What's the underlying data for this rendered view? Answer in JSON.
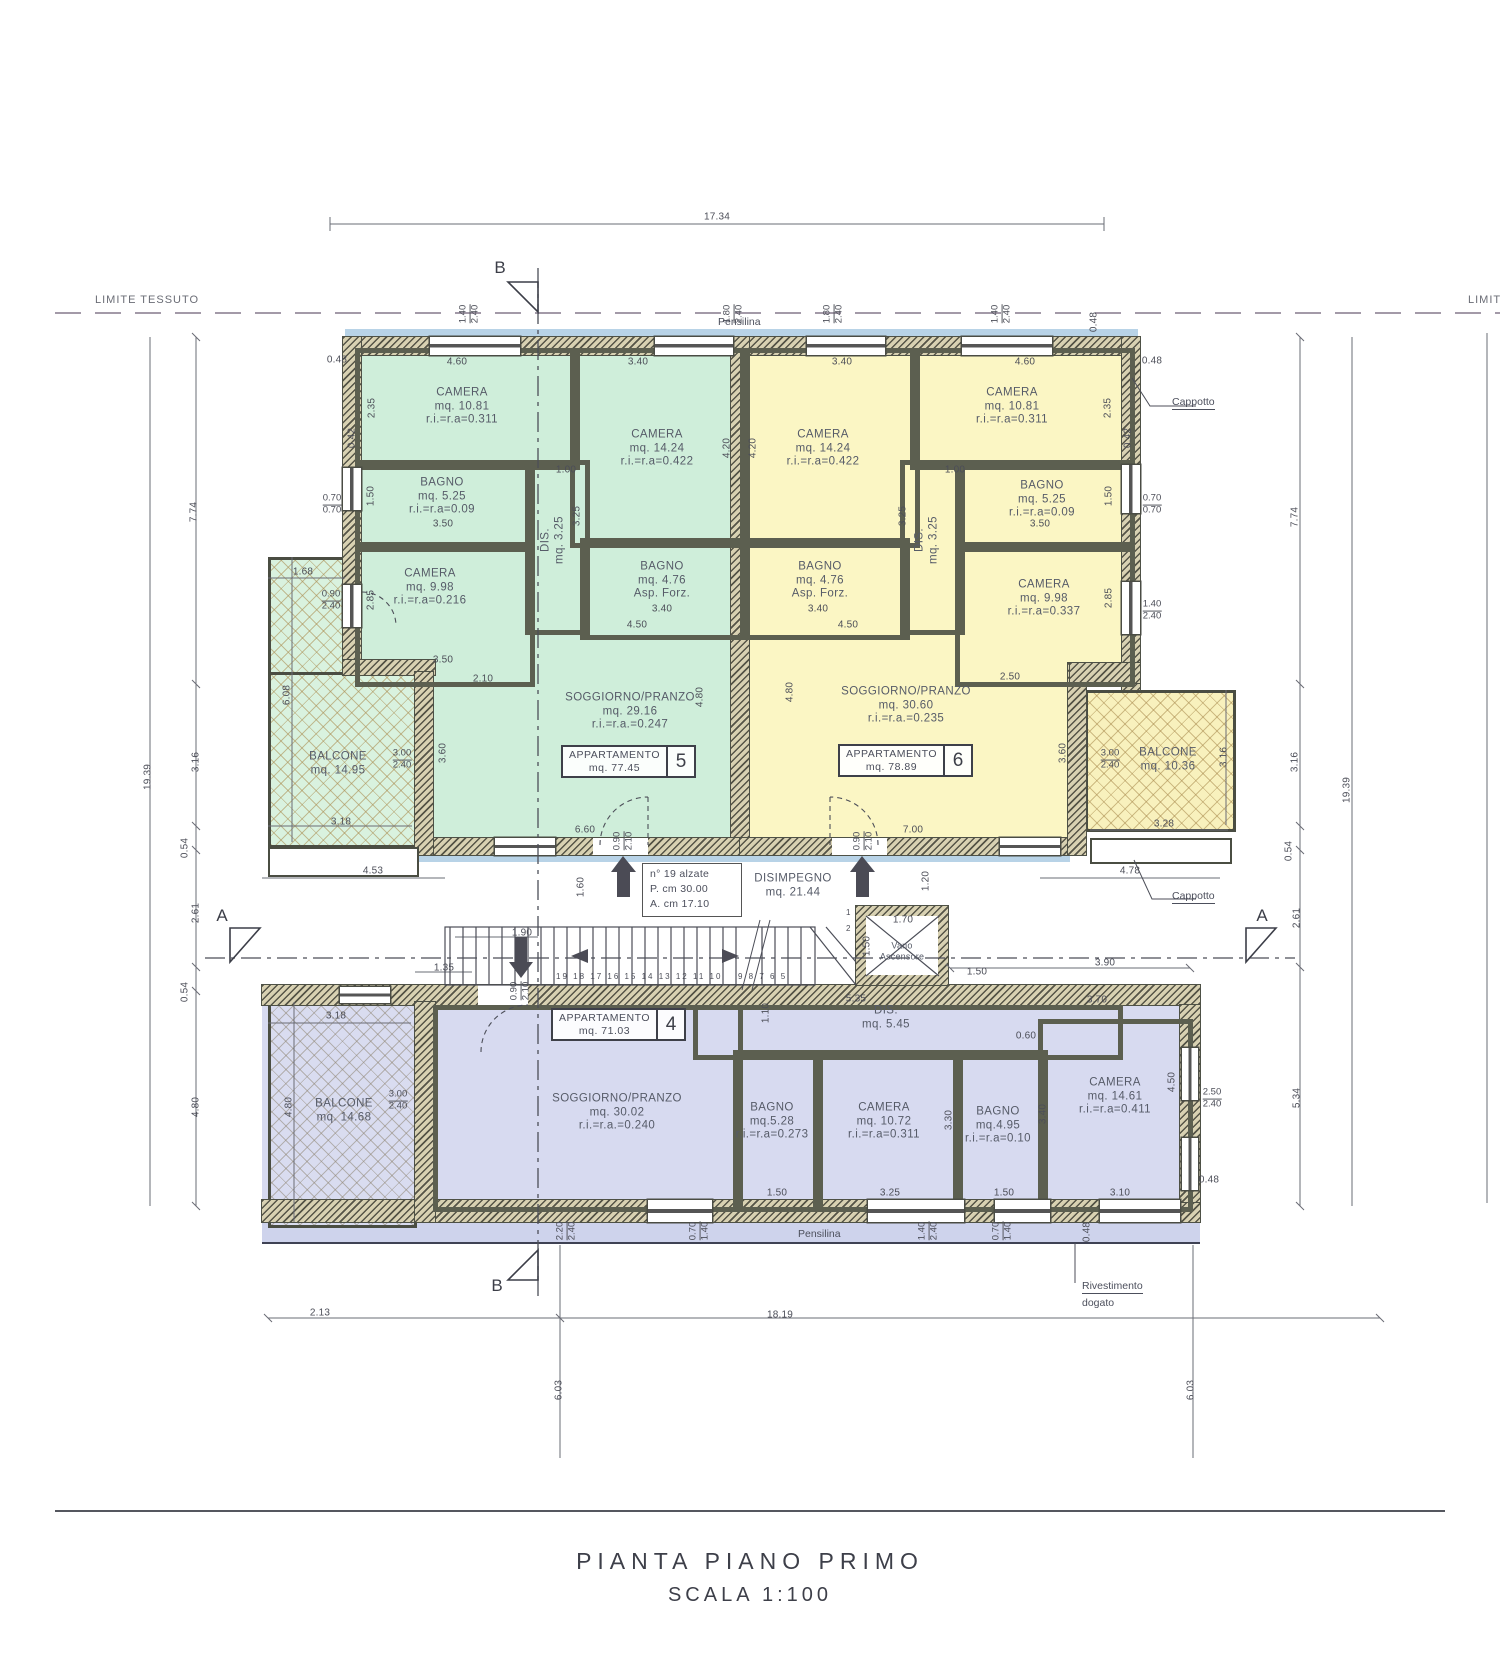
{
  "title": {
    "line1": "PIANTA  PIANO  PRIMO",
    "line2": "SCALA  1:100"
  },
  "labels": {
    "limite_left": "LIMITE TESSUTO",
    "limite_right": "LIMITE TESSUTO",
    "pensilina_top": "Pensilina",
    "pensilina_bottom": "Pensilina",
    "cappotto_top": "Cappotto",
    "cappotto_mid": "Cappotto",
    "rivestimento_line1": "Rivestimento",
    "rivestimento_line2": "dogato",
    "section_a": "A",
    "section_b": "B"
  },
  "stair_note": {
    "line1": "n° 19 alzate",
    "line2": "P.  cm 30.00",
    "line3": "A. cm 17.10"
  },
  "hall": {
    "name": "DISIMPEGNO",
    "area": "mq. 21.44"
  },
  "elevator": {
    "line1": "Vano",
    "line2": "Ascensore"
  },
  "stairs": {
    "numbers_left": "19 18 17 16 15 14 13 12 11 10",
    "numbers_right": "9  8  7  6  5",
    "digit_1": "1",
    "digit_2": "2"
  },
  "apartments": [
    {
      "name": "APPARTAMENTO",
      "area": "mq. 77.45",
      "number": "5"
    },
    {
      "name": "APPARTAMENTO",
      "area": "mq. 78.89",
      "number": "6"
    },
    {
      "name": "APPARTAMENTO",
      "area": "mq. 71.03",
      "number": "4"
    }
  ],
  "colors": {
    "apt5_fill": "#cfeeda",
    "apt6_fill": "#fbf6c4",
    "apt4_fill": "#d7daf0",
    "wall_hatch": "#d8d1b2",
    "trim_teal": "#8ecfc0",
    "trim_blue": "#b3d2e6",
    "line_dark": "#3e4049",
    "dim_text": "#4c4e58"
  },
  "rooms": [
    {
      "lines": [
        "CAMERA",
        "mq. 10.81",
        "r.i.=r.a=0.311"
      ],
      "x": 462,
      "y": 407
    },
    {
      "lines": [
        "CAMERA",
        "mq. 14.24",
        "r.i.=r.a=0.422"
      ],
      "x": 657,
      "y": 449
    },
    {
      "lines": [
        "BAGNO",
        "mq. 5.25",
        "r.i.=r.a=0.09"
      ],
      "x": 442,
      "y": 497
    },
    {
      "lines": [
        "CAMERA",
        "mq. 9.98",
        "r.i.=r.a=0.216"
      ],
      "x": 430,
      "y": 588
    },
    {
      "lines": [
        "DIS.",
        "mq. 3.25"
      ],
      "x": 553,
      "y": 540,
      "rot": 1
    },
    {
      "lines": [
        "BAGNO",
        "mq. 4.76",
        "Asp. Forz."
      ],
      "x": 662,
      "y": 581
    },
    {
      "lines": [
        "SOGGIORNO/PRANZO",
        "mq. 29.16",
        "r.i.=r.a.=0.247"
      ],
      "x": 630,
      "y": 712
    },
    {
      "lines": [
        "CAMERA",
        "mq. 14.24",
        "r.i.=r.a=0.422"
      ],
      "x": 823,
      "y": 449
    },
    {
      "lines": [
        "CAMERA",
        "mq. 10.81",
        "r.i.=r.a=0.311"
      ],
      "x": 1012,
      "y": 407
    },
    {
      "lines": [
        "BAGNO",
        "mq. 5.25",
        "r.i.=r.a=0.09"
      ],
      "x": 1042,
      "y": 500
    },
    {
      "lines": [
        "DIS.",
        "mq. 3.25"
      ],
      "x": 927,
      "y": 540,
      "rot": 1
    },
    {
      "lines": [
        "BAGNO",
        "mq. 4.76",
        "Asp. Forz."
      ],
      "x": 820,
      "y": 581
    },
    {
      "lines": [
        "CAMERA",
        "mq. 9.98",
        "r.i.=r.a=0.337"
      ],
      "x": 1044,
      "y": 599
    },
    {
      "lines": [
        "SOGGIORNO/PRANZO",
        "mq. 30.60",
        "r.i.=r.a.=0.235"
      ],
      "x": 906,
      "y": 706
    },
    {
      "lines": [
        "SOGGIORNO/PRANZO",
        "mq. 30.02",
        "r.i.=r.a.=0.240"
      ],
      "x": 617,
      "y": 1113
    },
    {
      "lines": [
        "BAGNO",
        "mq.5.28",
        "r.i.=r.a=0.273"
      ],
      "x": 772,
      "y": 1122
    },
    {
      "lines": [
        "CAMERA",
        "mq. 10.72",
        "r.i.=r.a=0.311"
      ],
      "x": 884,
      "y": 1122
    },
    {
      "lines": [
        "BAGNO",
        "mq.4.95",
        "r.i.=r.a=0.10"
      ],
      "x": 998,
      "y": 1126
    },
    {
      "lines": [
        "CAMERA",
        "mq. 14.61",
        "r.i.=r.a=0.411"
      ],
      "x": 1115,
      "y": 1097
    },
    {
      "lines": [
        "DIS.",
        "mq. 5.45"
      ],
      "x": 886,
      "y": 1018
    }
  ],
  "balconies": [
    {
      "lines": [
        "BALCONE",
        "mq. 14.95"
      ],
      "x": 338,
      "y": 764
    },
    {
      "lines": [
        "BALCONE",
        "mq. 10.36"
      ],
      "x": 1168,
      "y": 760
    },
    {
      "lines": [
        "BALCONE",
        "mq. 14.68"
      ],
      "x": 344,
      "y": 1111
    }
  ],
  "dims": [
    {
      "t": "17.34",
      "x": 717,
      "y": 217
    },
    {
      "t": "0.48",
      "x": 337,
      "y": 360
    },
    {
      "t": "4.60",
      "x": 457,
      "y": 362
    },
    {
      "t": "3.40",
      "x": 638,
      "y": 362
    },
    {
      "t": "3.40",
      "x": 842,
      "y": 362
    },
    {
      "t": "4.60",
      "x": 1025,
      "y": 362
    },
    {
      "t": "0.48",
      "x": 1152,
      "y": 361
    },
    {
      "t": "0.48",
      "x": 1094,
      "y": 322,
      "r": 1
    },
    {
      "t": "19.39",
      "x": 148,
      "y": 777,
      "r": 1
    },
    {
      "t": "7.74",
      "x": 194,
      "y": 512,
      "r": 1
    },
    {
      "t": "3.16",
      "x": 196,
      "y": 762,
      "r": 1
    },
    {
      "t": "0.54",
      "x": 185,
      "y": 848,
      "r": 1
    },
    {
      "t": "2.61",
      "x": 196,
      "y": 913,
      "r": 1
    },
    {
      "t": "0.54",
      "x": 185,
      "y": 992,
      "r": 1
    },
    {
      "t": "4.80",
      "x": 196,
      "y": 1107,
      "r": 1
    },
    {
      "t": "19.39",
      "x": 1347,
      "y": 790,
      "r": 1
    },
    {
      "t": "7.74",
      "x": 1295,
      "y": 517,
      "r": 1
    },
    {
      "t": "3.16",
      "x": 1295,
      "y": 762,
      "r": 1
    },
    {
      "t": "0.54",
      "x": 1289,
      "y": 851,
      "r": 1
    },
    {
      "t": "2.61",
      "x": 1297,
      "y": 918,
      "r": 1
    },
    {
      "t": "5.34",
      "x": 1297,
      "y": 1098,
      "r": 1
    },
    {
      "t": "3.16",
      "x": 1224,
      "y": 757,
      "r": 1
    },
    {
      "t": "6.08",
      "x": 287,
      "y": 695,
      "r": 1
    },
    {
      "t": "1.68",
      "x": 303,
      "y": 572
    },
    {
      "t": "3.18",
      "x": 341,
      "y": 822
    },
    {
      "t": "4.53",
      "x": 373,
      "y": 871
    },
    {
      "t": "4.80",
      "x": 289,
      "y": 1107,
      "r": 1
    },
    {
      "t": "3.18",
      "x": 336,
      "y": 1016
    },
    {
      "t": "2.35",
      "x": 372,
      "y": 408,
      "r": 1
    },
    {
      "t": "0.42",
      "x": 352,
      "y": 438,
      "r": 1
    },
    {
      "t": "1.50",
      "x": 371,
      "y": 496,
      "r": 1
    },
    {
      "t": "3.50",
      "x": 443,
      "y": 524
    },
    {
      "t": "1.00",
      "x": 566,
      "y": 470
    },
    {
      "t": "3.25",
      "x": 577,
      "y": 516,
      "r": 1
    },
    {
      "t": "2.85",
      "x": 371,
      "y": 600,
      "r": 1
    },
    {
      "t": "3.50",
      "x": 443,
      "y": 660
    },
    {
      "t": "2.10",
      "x": 483,
      "y": 679
    },
    {
      "t": "3.40",
      "x": 662,
      "y": 609
    },
    {
      "t": "4.50",
      "x": 637,
      "y": 625
    },
    {
      "t": "4.20",
      "x": 727,
      "y": 448,
      "r": 1
    },
    {
      "t": "4.20",
      "x": 753,
      "y": 448,
      "r": 1
    },
    {
      "t": "3.60",
      "x": 443,
      "y": 753,
      "r": 1
    },
    {
      "t": "6.60",
      "x": 585,
      "y": 830
    },
    {
      "t": "4.80",
      "x": 700,
      "y": 697,
      "r": 1
    },
    {
      "t": "4.80",
      "x": 790,
      "y": 692,
      "r": 1
    },
    {
      "t": "2.35",
      "x": 1108,
      "y": 408,
      "r": 1
    },
    {
      "t": "0.42",
      "x": 1128,
      "y": 438,
      "r": 1
    },
    {
      "t": "1.50",
      "x": 1109,
      "y": 496,
      "r": 1
    },
    {
      "t": "3.50",
      "x": 1040,
      "y": 524
    },
    {
      "t": "1.00",
      "x": 955,
      "y": 470
    },
    {
      "t": "3.25",
      "x": 903,
      "y": 516,
      "r": 1
    },
    {
      "t": "2.85",
      "x": 1109,
      "y": 598,
      "r": 1
    },
    {
      "t": "2.50",
      "x": 1010,
      "y": 677
    },
    {
      "t": "3.40",
      "x": 818,
      "y": 609
    },
    {
      "t": "4.50",
      "x": 848,
      "y": 625
    },
    {
      "t": "3.60",
      "x": 1063,
      "y": 753,
      "r": 1
    },
    {
      "t": "7.00",
      "x": 913,
      "y": 830
    },
    {
      "t": "3.28",
      "x": 1164,
      "y": 824
    },
    {
      "t": "4.78",
      "x": 1130,
      "y": 871
    },
    {
      "t": "1.90",
      "x": 522,
      "y": 933
    },
    {
      "t": "1.35",
      "x": 444,
      "y": 968
    },
    {
      "t": "1.60",
      "x": 581,
      "y": 887,
      "r": 1
    },
    {
      "t": "1.20",
      "x": 926,
      "y": 881,
      "r": 1
    },
    {
      "t": "1.70",
      "x": 903,
      "y": 920
    },
    {
      "t": "1.50",
      "x": 977,
      "y": 972
    },
    {
      "t": "1.50",
      "x": 867,
      "y": 946,
      "r": 1
    },
    {
      "t": "5.35",
      "x": 856,
      "y": 999
    },
    {
      "t": "1.10",
      "x": 766,
      "y": 1013,
      "r": 1
    },
    {
      "t": "0.60",
      "x": 1026,
      "y": 1036
    },
    {
      "t": "3.70",
      "x": 1097,
      "y": 1000
    },
    {
      "t": "3.90",
      "x": 1105,
      "y": 963
    },
    {
      "t": "3.30",
      "x": 949,
      "y": 1120,
      "r": 1
    },
    {
      "t": "3.40",
      "x": 1043,
      "y": 1114,
      "r": 1
    },
    {
      "t": "4.50",
      "x": 1172,
      "y": 1082,
      "r": 1
    },
    {
      "t": "0.48",
      "x": 1209,
      "y": 1180
    },
    {
      "t": "1.50",
      "x": 777,
      "y": 1193
    },
    {
      "t": "3.25",
      "x": 890,
      "y": 1193
    },
    {
      "t": "1.50",
      "x": 1004,
      "y": 1193
    },
    {
      "t": "3.10",
      "x": 1120,
      "y": 1193
    },
    {
      "t": "0.48",
      "x": 1087,
      "y": 1232,
      "r": 1
    },
    {
      "t": "2.13",
      "x": 320,
      "y": 1313
    },
    {
      "t": "18.19",
      "x": 780,
      "y": 1315
    },
    {
      "t": "6.03",
      "x": 559,
      "y": 1390,
      "r": 1
    },
    {
      "t": "6.03",
      "x": 1191,
      "y": 1390,
      "r": 1
    }
  ],
  "pairs": [
    {
      "a": "1.40",
      "b": "2.40",
      "x": 470,
      "y": 314,
      "r": 1
    },
    {
      "a": "1.80",
      "b": "2.40",
      "x": 734,
      "y": 314,
      "r": 1
    },
    {
      "a": "1.80",
      "b": "2.40",
      "x": 834,
      "y": 314,
      "r": 1
    },
    {
      "a": "1.40",
      "b": "2.40",
      "x": 1002,
      "y": 314,
      "r": 1
    },
    {
      "a": "0.70",
      "b": "0.70",
      "x": 332,
      "y": 505
    },
    {
      "a": "0.90",
      "b": "2.40",
      "x": 331,
      "y": 601
    },
    {
      "a": "0.70",
      "b": "0.70",
      "x": 1152,
      "y": 505
    },
    {
      "a": "1.40",
      "b": "2.40",
      "x": 1152,
      "y": 611
    },
    {
      "a": "3.00",
      "b": "2.40",
      "x": 402,
      "y": 760
    },
    {
      "a": "3.00",
      "b": "2.40",
      "x": 1110,
      "y": 760
    },
    {
      "a": "0.90",
      "b": "2.10",
      "x": 624,
      "y": 841,
      "r": 1
    },
    {
      "a": "0.90",
      "b": "2.10",
      "x": 864,
      "y": 841,
      "r": 1
    },
    {
      "a": "0.90",
      "b": "2.10",
      "x": 521,
      "y": 991,
      "r": 1
    },
    {
      "a": "3.00",
      "b": "2.40",
      "x": 398,
      "y": 1101
    },
    {
      "a": "2.50",
      "b": "2.40",
      "x": 1212,
      "y": 1099
    },
    {
      "a": "2.20",
      "b": "2.40",
      "x": 567,
      "y": 1231,
      "r": 1
    },
    {
      "a": "0.70",
      "b": "1.40",
      "x": 700,
      "y": 1231,
      "r": 1
    },
    {
      "a": "1.40",
      "b": "2.40",
      "x": 929,
      "y": 1231,
      "r": 1
    },
    {
      "a": "0.70",
      "b": "1.40",
      "x": 1003,
      "y": 1231,
      "r": 1
    }
  ]
}
